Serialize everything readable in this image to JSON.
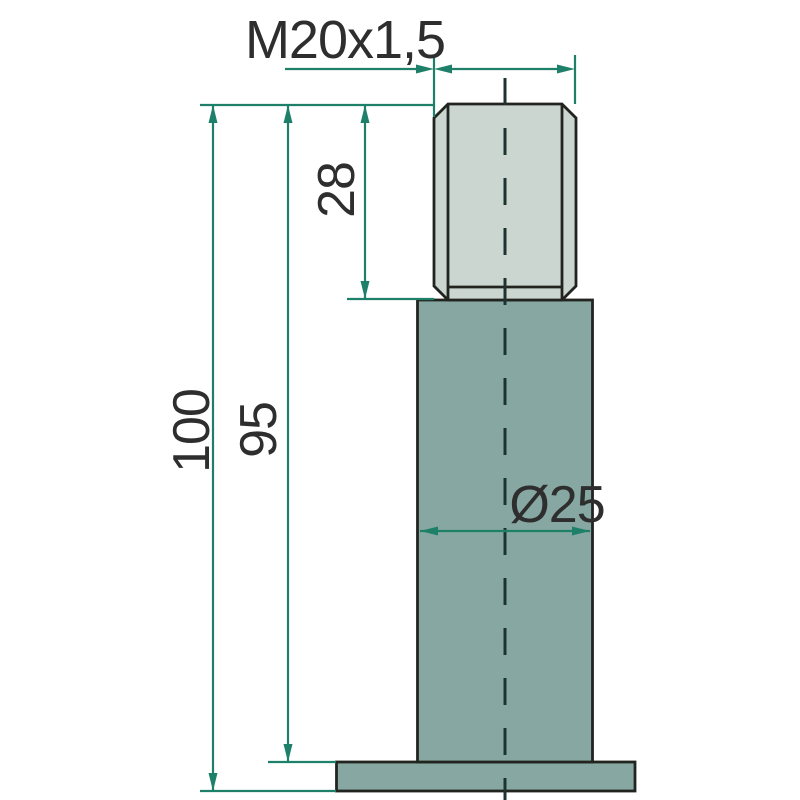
{
  "drawing": {
    "title": "threaded-pin-technical-drawing",
    "labels": {
      "thread_spec": "M20x1,5",
      "thread_length": "28",
      "overall_length": "100",
      "body_length": "95",
      "diameter": "Ø25"
    },
    "colors": {
      "background": "#ffffff",
      "dimension": "#1e8069",
      "outline": "#22251f",
      "thread_fill": "#ccd6d1",
      "body_fill": "#87a8a2",
      "centerline_color": "#1c3330",
      "text": "#2e2e2e"
    }
  }
}
